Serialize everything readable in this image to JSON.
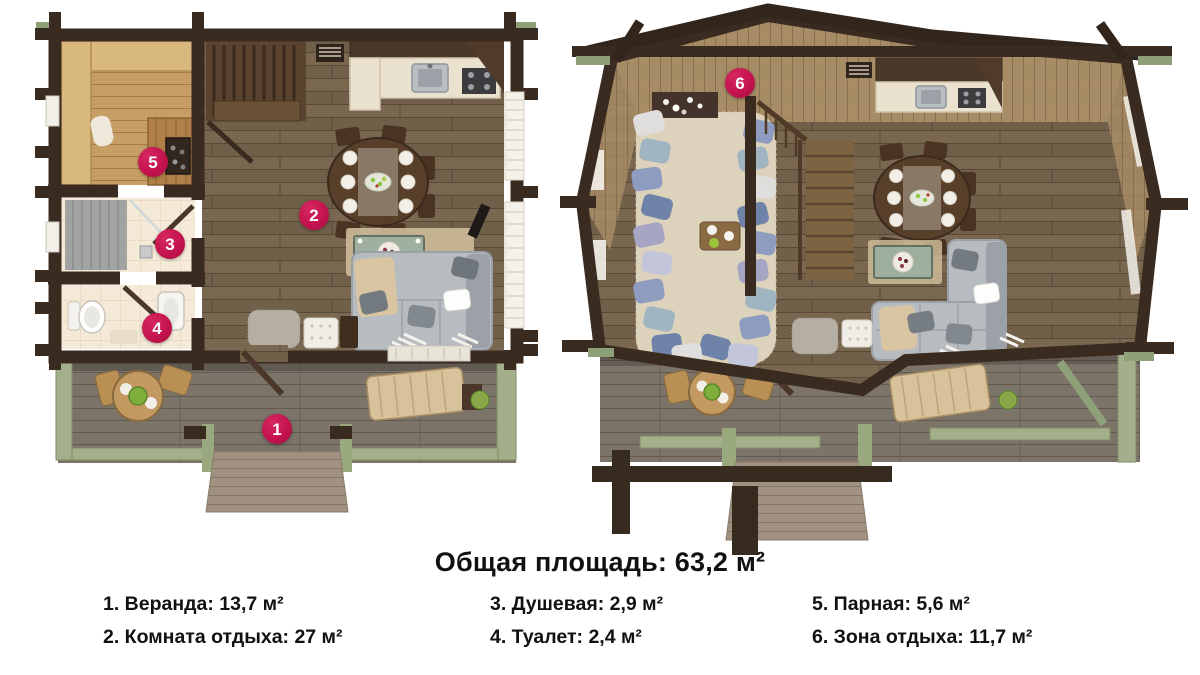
{
  "title": "Общая площадь: 63,2 м²",
  "legend": {
    "columns": [
      {
        "items": [
          {
            "text": "1. Веранда: 13,7 м²"
          },
          {
            "text": "2. Комната отдыха: 27 м²"
          }
        ]
      },
      {
        "items": [
          {
            "text": "3. Душевая: 2,9 м²"
          },
          {
            "text": "4. Туалет: 2,4 м²"
          }
        ]
      },
      {
        "items": [
          {
            "text": "5. Парная: 5,6 м²"
          },
          {
            "text": "6. Зона отдыха: 11,7 м²"
          }
        ]
      }
    ]
  },
  "markers": [
    {
      "num": "1",
      "room": "Веранда"
    },
    {
      "num": "2",
      "room": "Комната отдыха"
    },
    {
      "num": "3",
      "room": "Душевая"
    },
    {
      "num": "4",
      "room": "Туалет"
    },
    {
      "num": "5",
      "room": "Парная"
    },
    {
      "num": "6",
      "room": "Зона отдыха"
    }
  ],
  "colors": {
    "marker_accent": "#c4134e",
    "log_wall": "#3a2b21",
    "dark_floor": "#79664f",
    "sauna_wood": "#c79e66",
    "deck_gray": "#7d7469",
    "beam_green": "#a3af8a",
    "lounge_rug": "#ddd2bb"
  }
}
